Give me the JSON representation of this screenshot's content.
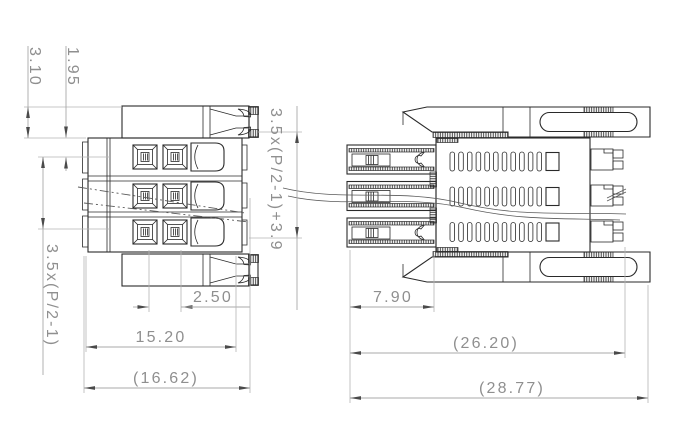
{
  "drawing": {
    "type": "connector-technical-drawing",
    "views": {
      "left": "front-view",
      "right": "side-view"
    },
    "dimensions": {
      "flange_height": "3.10",
      "contact_row_offset": "1.95",
      "row_pitch_formula": "3.5x(P/2-1)",
      "height_formula": "3.5x(P/2-1)+3.9",
      "contact_spacing": "2.50",
      "body_width": "15.20",
      "overall_width": "(16.62)",
      "pin_length": "7.90",
      "body_length": "(26.20)",
      "overall_length": "(28.77)"
    },
    "colors": {
      "background": "#ffffff",
      "drawing_line": "#2a2a2a",
      "dimension_line": "#a8a8a8",
      "dimension_text": "#8f8f8f",
      "break_line": "#5a5a5a"
    }
  }
}
